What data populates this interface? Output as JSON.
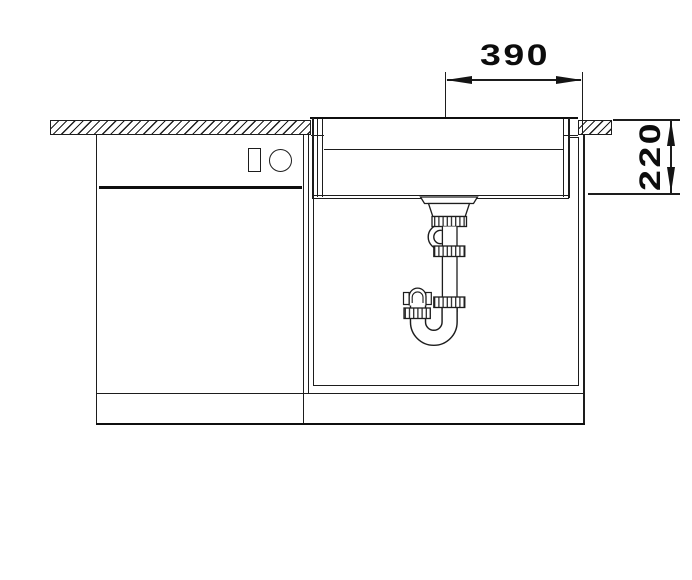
{
  "diagram": {
    "background": "#ffffff",
    "line_color": "#1d1d1d",
    "dimensions": {
      "horizontal": {
        "label": "390",
        "orientation": "horizontal"
      },
      "vertical": {
        "label": "220",
        "orientation": "vertical"
      }
    },
    "components": {
      "worktop": "hatched worktop cross-section",
      "sink_bowl": "flush-mounted sink bowl cross-section",
      "drain": "strainer basket with tailpipe",
      "trap": "p-trap siphon",
      "appliance": "appliance front with control panel",
      "base_cabinet": "sink base cabinet",
      "plinth": "plinth"
    }
  }
}
